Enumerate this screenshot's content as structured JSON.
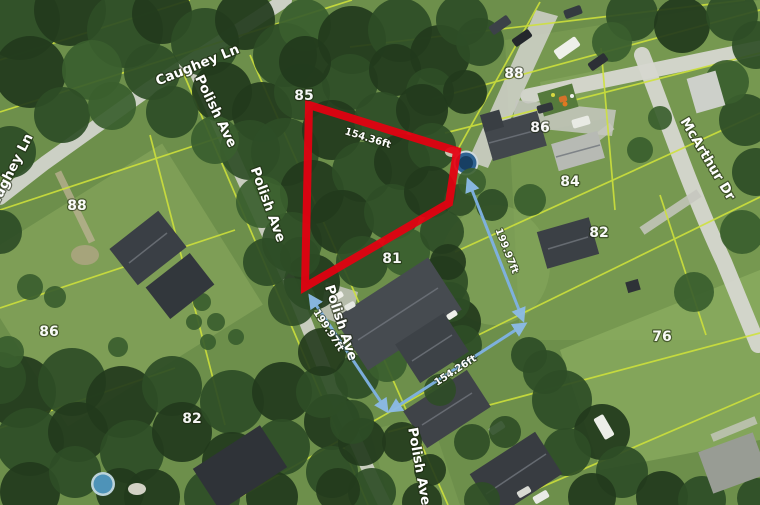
{
  "map": {
    "streets": {
      "caughey_upper": "Caughey Ln",
      "caughey_left": "Caughey Ln",
      "polish_1": "Polish Ave",
      "polish_2": "Polish Ave",
      "polish_3": "Polish Ave",
      "polish_4": "Polish Ave",
      "mcarthur": "McArthur Dr"
    },
    "parcel_numbers": {
      "p85": "85",
      "p88_right": "88",
      "p86_right": "86",
      "p84": "84",
      "p82_right": "82",
      "p76": "76",
      "p81": "81",
      "p88_left": "88",
      "p86_left": "86",
      "p82_left": "82"
    },
    "measurements": {
      "highlight_top": "154.36ft",
      "side_right": "199.97ft",
      "side_left": "199.97ft",
      "frontage_bottom": "154.26ft"
    },
    "colors": {
      "highlight": "#e50010",
      "measure_line": "#7fb2e5",
      "parcel_line": "#cfe23b"
    }
  }
}
